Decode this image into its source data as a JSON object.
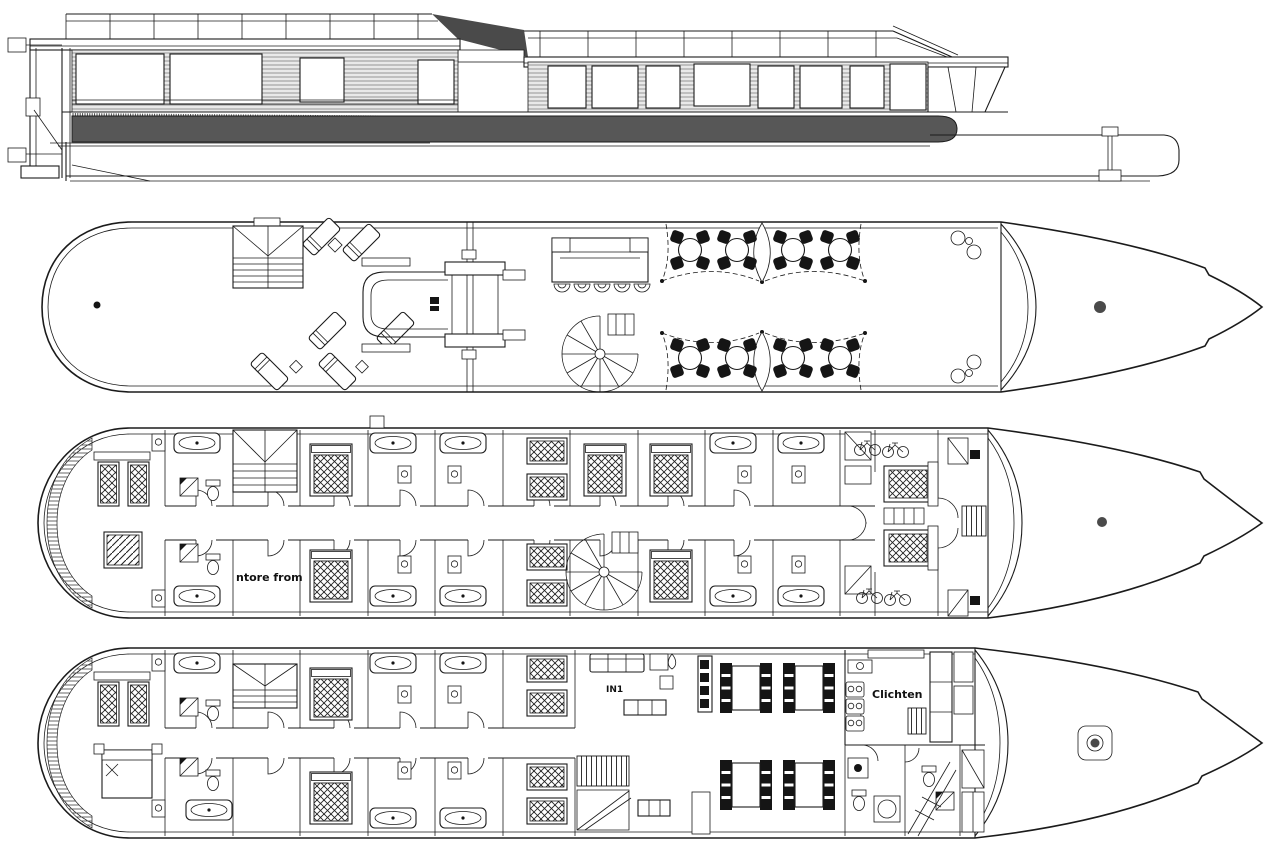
{
  "views": {
    "elevation": {
      "name": "side-elevation"
    },
    "deck_top": {
      "name": "sun-deck-plan"
    },
    "deck_cabin": {
      "name": "cabin-deck-plan"
    },
    "deck_lower": {
      "name": "lower-deck-plan"
    }
  },
  "annotations": {
    "cabin_deck_note": "ntore from",
    "lounge_label": "IN1",
    "galley_label": "Clichten"
  },
  "colors": {
    "line": "#1b1b1b",
    "hull_band": "#575757",
    "mast_dot": "#4a4a4a",
    "background": "#ffffff"
  }
}
